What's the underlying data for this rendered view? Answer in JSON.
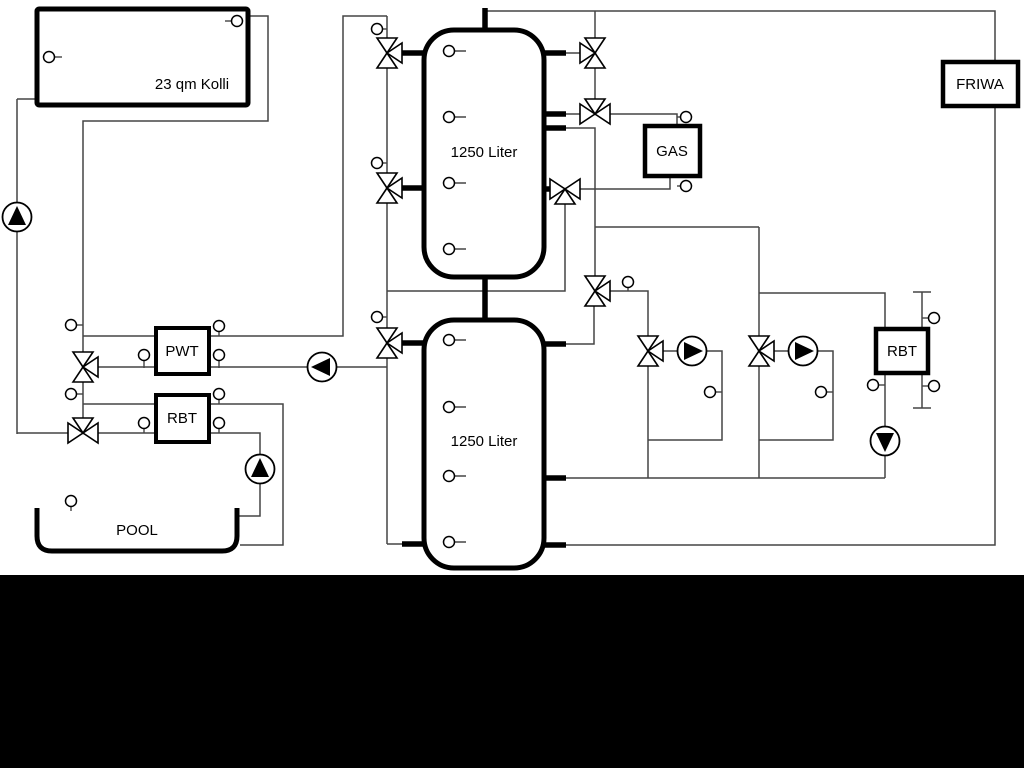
{
  "diagram": {
    "type": "hydraulic-heating-schematic",
    "labels": {
      "collector": "23 qm Kolli",
      "tank_top": "1250 Liter",
      "tank_bottom": "1250 Liter",
      "pwt": "PWT",
      "rbt_left": "RBT",
      "rbt_right": "RBT",
      "gas": "GAS",
      "friwa": "FRIWA",
      "pool": "POOL"
    },
    "colors": {
      "background": "#ffffff",
      "pipe_line": "#454545",
      "component_outline": "#000000",
      "footer_band": "#000000",
      "symbol_fill": "#ffffff",
      "pump_triangle": "#000000"
    },
    "equipment": {
      "pumps": [
        {
          "name": "solar-pump",
          "direction": "up"
        },
        {
          "name": "buffer-charge-pump",
          "direction": "left"
        },
        {
          "name": "pool-pump",
          "direction": "up"
        },
        {
          "name": "heating-circuit-1-pump",
          "direction": "right"
        },
        {
          "name": "heating-circuit-2-pump",
          "direction": "right"
        },
        {
          "name": "rbt-right-pump",
          "direction": "down"
        }
      ],
      "three_way_valve_count": 11,
      "temperature_sensor_count": 30
    }
  }
}
